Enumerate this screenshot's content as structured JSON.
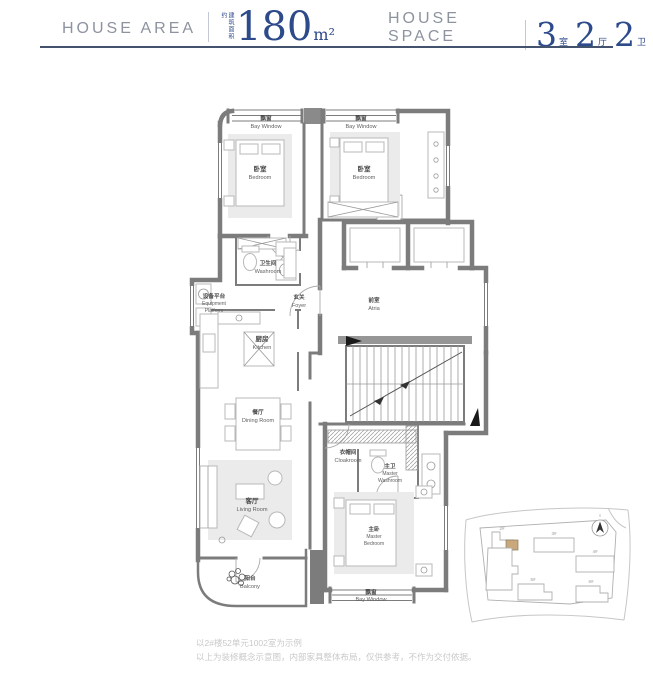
{
  "header": {
    "area": {
      "label": "HOUSE AREA",
      "note": "建筑面积约",
      "value": "180",
      "unit": "m²"
    },
    "space": {
      "label": "HOUSE SPACE",
      "parts": [
        {
          "num": "3",
          "unit": "室"
        },
        {
          "num": "2",
          "unit": "厅"
        },
        {
          "num": "2",
          "unit": "卫"
        }
      ]
    }
  },
  "floorplan": {
    "rooms": {
      "bay_tl": {
        "zh": "飘窗",
        "en": "Bay Window"
      },
      "bay_tr": {
        "zh": "飘窗",
        "en": "Bay Window"
      },
      "bedroom_l": {
        "zh": "卧室",
        "en": "Bedroom"
      },
      "bedroom_r": {
        "zh": "卧室",
        "en": "Bedroom"
      },
      "washroom": {
        "zh": "卫生间",
        "en": "Washroom"
      },
      "equipment": {
        "zh": "设备平台",
        "en1": "Equipment",
        "en2": "Platform"
      },
      "foyer": {
        "zh": "玄关",
        "en": "Foyer"
      },
      "atria": {
        "zh": "前室",
        "en": "Atria"
      },
      "kitchen": {
        "zh": "厨房",
        "en": "Kitchen"
      },
      "dining": {
        "zh": "餐厅",
        "en": "Dining Room"
      },
      "cloakroom": {
        "zh": "衣帽间",
        "en": "Cloakroom"
      },
      "master_wash": {
        "zh": "主卫",
        "en1": "Master",
        "en2": "Washroom"
      },
      "living": {
        "zh": "客厅",
        "en": "Living Room"
      },
      "master_bed": {
        "zh": "主卧",
        "en1": "Master",
        "en2": "Bedroom"
      },
      "balcony": {
        "zh": "阳台",
        "en": "Balcony"
      },
      "bay_b": {
        "zh": "飘窗",
        "en": "Bay Window"
      }
    }
  },
  "siteplan": {
    "buildings": [
      {
        "label": "2#"
      },
      {
        "label": "3#"
      },
      {
        "label": "4#"
      },
      {
        "label": "5#"
      },
      {
        "label": "6#"
      }
    ]
  },
  "footnotes": {
    "line1": "以2#楼52单元1002室为示例",
    "line2": "以上为装修概念示意图，内部家具整体布局，仅供参考，不作为交付依据。"
  },
  "colors": {
    "accent_navy": "#2d4a8a",
    "header_gray": "#8d939f",
    "rule": "#43536e",
    "wall_gray": "#7c7c7c",
    "furniture_gray": "#ebebeb",
    "note_gray": "#c9c9c9",
    "site_highlight": "#c9a87c"
  }
}
